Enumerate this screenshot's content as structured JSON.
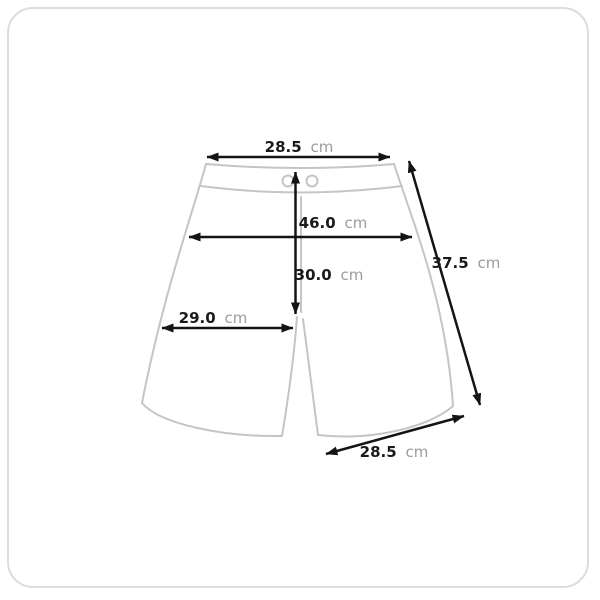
{
  "colors": {
    "background": "#ffffff",
    "card_border": "#dcdcdc",
    "garment_outline": "#c5c5c5",
    "dimension_line": "#141414",
    "value_text": "#1a1a1a",
    "unit_text": "#9b9b9b"
  },
  "measurements": {
    "waist_width": {
      "value": "28.5",
      "unit": "cm"
    },
    "hip_width": {
      "value": "46.0",
      "unit": "cm"
    },
    "front_rise": {
      "value": "30.0",
      "unit": "cm"
    },
    "thigh_width": {
      "value": "29.0",
      "unit": "cm"
    },
    "side_length": {
      "value": "37.5",
      "unit": "cm"
    },
    "leg_opening": {
      "value": "28.5",
      "unit": "cm"
    }
  }
}
